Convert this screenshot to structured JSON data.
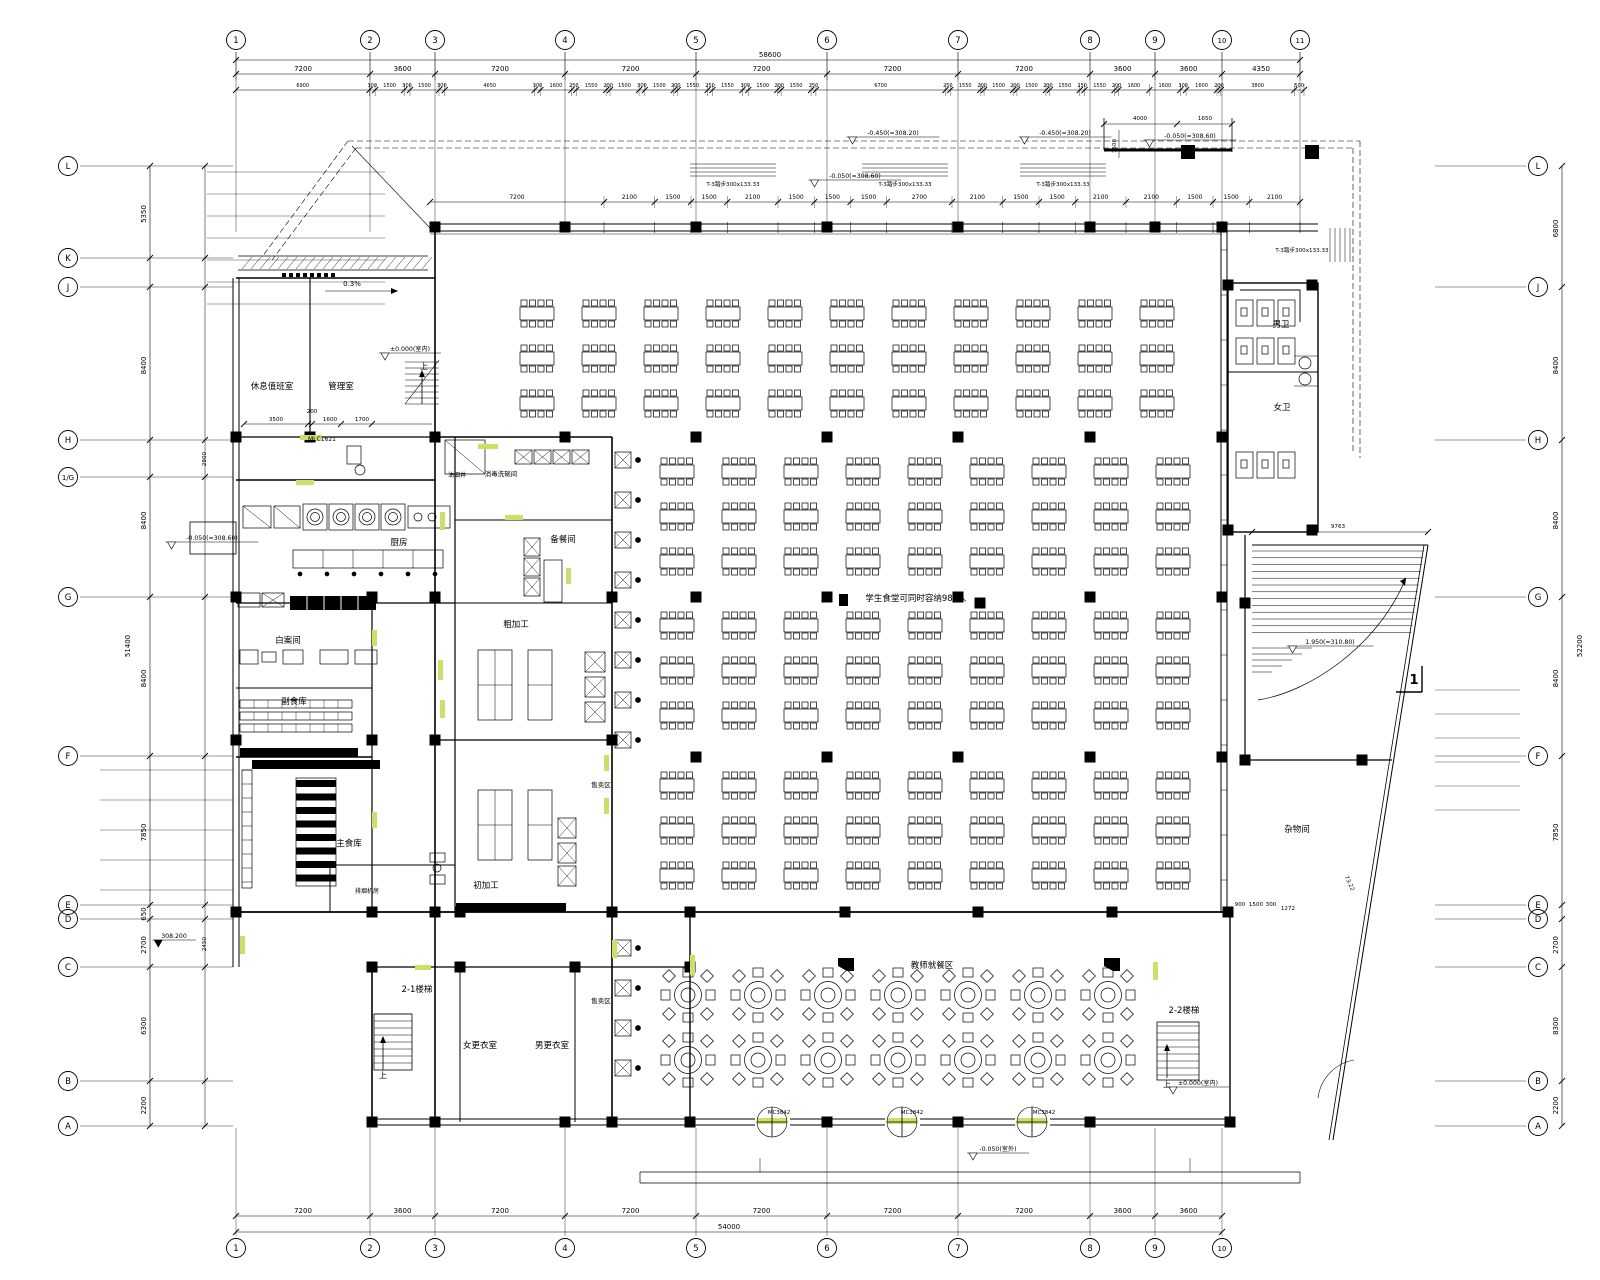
{
  "meta": {
    "drawing_type": "architectural-floor-plan",
    "language": "zh-CN"
  },
  "colors": {
    "line": "#000000",
    "background": "#ffffff",
    "door_highlight": "#c9e069",
    "column_fill": "#000000"
  },
  "axes": {
    "top": {
      "labels": [
        "1",
        "2",
        "3",
        "4",
        "5",
        "6",
        "7",
        "8",
        "9",
        "10",
        "11"
      ]
    },
    "bottom": {
      "labels": [
        "1",
        "2",
        "3",
        "4",
        "5",
        "6",
        "7",
        "8",
        "9",
        "10"
      ]
    },
    "left": {
      "labels": [
        "L",
        "K",
        "J",
        "H",
        "1/G",
        "G",
        "F",
        "E",
        "D",
        "C",
        "B",
        "A"
      ]
    },
    "right": {
      "labels": [
        "L",
        "J",
        "H",
        "G",
        "F",
        "E",
        "D",
        "C",
        "B",
        "A"
      ]
    }
  },
  "dimensions": {
    "top_total": "58600",
    "top_axis_dims": [
      "7200",
      "3600",
      "7200",
      "7200",
      "7200",
      "7200",
      "7200",
      "3600",
      "3600",
      "4350"
    ],
    "top_detail_dims": [
      "6900",
      "300",
      "1500",
      "300",
      "1500",
      "300",
      "4650",
      "300",
      "1600",
      "250",
      "1550",
      "200",
      "1500",
      "300",
      "1500",
      "200",
      "1550",
      "250",
      "1550",
      "300",
      "1500",
      "200",
      "1550",
      "250",
      "6700",
      "250",
      "1550",
      "200",
      "1500",
      "200",
      "1500",
      "200",
      "1550",
      "250",
      "1550",
      "200",
      "1600",
      "1600",
      "300",
      "1600",
      "200",
      "3800",
      "500"
    ],
    "window_dims": [
      "7200",
      "2100",
      "1500",
      "1500",
      "2100",
      "1500",
      "1500",
      "1500",
      "2700",
      "2100",
      "1500",
      "1500",
      "2100",
      "2100",
      "1500",
      "1500",
      "2100"
    ],
    "bottom_axis_dims": [
      "7200",
      "3600",
      "7200",
      "7200",
      "7200",
      "7200",
      "7200",
      "3600",
      "3600"
    ],
    "bottom_total": "54000",
    "left_axis_dims": [
      {
        "between": "L-K",
        "value": "5350"
      },
      {
        "between": "J-H",
        "value": "8400"
      },
      {
        "between": "H-G",
        "value": "8400"
      },
      {
        "between": "G-F",
        "value": "8400"
      },
      {
        "between": "F-E",
        "value": "7850"
      },
      {
        "between": "E-D",
        "value": "650"
      },
      {
        "between": "D-C",
        "value": "2700"
      },
      {
        "between": "C-B",
        "value": "6300"
      },
      {
        "between": "B-A",
        "value": "2200"
      }
    ],
    "left_total": "51400",
    "right_axis_dims": [
      {
        "between": "L-J",
        "value": "6800"
      },
      {
        "between": "J-H",
        "value": "8400"
      },
      {
        "between": "H-G",
        "value": "8400"
      },
      {
        "between": "G-F",
        "value": "8400"
      },
      {
        "between": "F-E",
        "value": "7850"
      },
      {
        "between": "D-C",
        "value": "2700"
      },
      {
        "between": "C-B",
        "value": "8300"
      },
      {
        "between": "B-A",
        "value": "2200"
      }
    ],
    "right_total": "52200",
    "misc": [
      {
        "t": "4000",
        "x": 1140,
        "y": 120
      },
      {
        "t": "1650",
        "x": 1205,
        "y": 120
      },
      {
        "t": "1500",
        "x": 1116,
        "y": 146,
        "rot": -90
      },
      {
        "t": "9763",
        "x": 1338,
        "y": 528
      },
      {
        "t": "3500",
        "x": 276,
        "y": 421
      },
      {
        "t": "200",
        "x": 312,
        "y": 413
      },
      {
        "t": "1600",
        "x": 330,
        "y": 421
      },
      {
        "t": "1700",
        "x": 362,
        "y": 421
      },
      {
        "t": "900",
        "x": 1240,
        "y": 906
      },
      {
        "t": "1500",
        "x": 1256,
        "y": 906
      },
      {
        "t": "300",
        "x": 1271,
        "y": 906
      },
      {
        "t": "1272",
        "x": 1288,
        "y": 910
      },
      {
        "t": "2800",
        "x": 206,
        "y": 459,
        "rot": -90
      },
      {
        "t": "2450",
        "x": 206,
        "y": 944,
        "rot": -90
      },
      {
        "t": "73.22",
        "x": 1348,
        "y": 884,
        "rot": 65
      }
    ]
  },
  "steps_note": "T-3踏步300x133.33",
  "steps_note_positions": [
    [
      733,
      186
    ],
    [
      905,
      186
    ],
    [
      1063,
      186
    ],
    [
      1302,
      252
    ]
  ],
  "elevations": [
    {
      "t": "-0.450(=308.20)",
      "x": 893,
      "y": 135
    },
    {
      "t": "-0.450(=308.20)",
      "x": 1065,
      "y": 135
    },
    {
      "t": "-0.050(=308.60)",
      "x": 1190,
      "y": 138
    },
    {
      "t": "-0.050(=308.60)",
      "x": 855,
      "y": 178
    },
    {
      "t": "±0.000(室内)",
      "x": 410,
      "y": 351
    },
    {
      "t": "-0.050(=308.60)",
      "x": 212,
      "y": 540
    },
    {
      "t": "308.200",
      "x": 174,
      "y": 938,
      "filled": true
    },
    {
      "t": "1.950(=310.80)",
      "x": 1330,
      "y": 644
    },
    {
      "t": "-0.050(室外)",
      "x": 998,
      "y": 1151
    },
    {
      "t": "±0.000(室内)",
      "x": 1198,
      "y": 1085
    }
  ],
  "rooms": [
    {
      "t": "休息值班室",
      "x": 272,
      "y": 389
    },
    {
      "t": "管理室",
      "x": 341,
      "y": 389
    },
    {
      "t": "油烟井",
      "x": 457,
      "y": 477,
      "s": 6
    },
    {
      "t": "消毒洗碗间",
      "x": 501,
      "y": 476,
      "s": 6.5
    },
    {
      "t": "备餐间",
      "x": 563,
      "y": 542
    },
    {
      "t": "厨房",
      "x": 399,
      "y": 545
    },
    {
      "t": "白案间",
      "x": 288,
      "y": 643
    },
    {
      "t": "副食库",
      "x": 294,
      "y": 704
    },
    {
      "t": "主食库",
      "x": 349,
      "y": 846
    },
    {
      "t": "排烟机房",
      "x": 367,
      "y": 893,
      "s": 6
    },
    {
      "t": "粗加工",
      "x": 516,
      "y": 627
    },
    {
      "t": "初加工",
      "x": 486,
      "y": 888
    },
    {
      "t": "售卖区",
      "x": 601,
      "y": 787,
      "s": 6.5
    },
    {
      "t": "售卖区",
      "x": 601,
      "y": 1003,
      "s": 6.5
    },
    {
      "t": "女更衣室",
      "x": 480,
      "y": 1048
    },
    {
      "t": "男更衣室",
      "x": 552,
      "y": 1048
    },
    {
      "t": "男卫",
      "x": 1281,
      "y": 327
    },
    {
      "t": "女卫",
      "x": 1282,
      "y": 410
    },
    {
      "t": "杂物间",
      "x": 1297,
      "y": 832
    },
    {
      "t": "2-1楼梯",
      "x": 417,
      "y": 992
    },
    {
      "t": "2-2楼梯",
      "x": 1184,
      "y": 1013
    },
    {
      "t": "教师就餐区",
      "x": 932,
      "y": 968
    },
    {
      "t": "学生食堂可同时容纳984人",
      "x": 916,
      "y": 601
    }
  ],
  "tags": [
    {
      "t": "MLC1621",
      "x": 322,
      "y": 441,
      "s": 6
    },
    {
      "t": "MC3842",
      "x": 779,
      "y": 1114,
      "s": 5.5
    },
    {
      "t": "MC3842",
      "x": 912,
      "y": 1114,
      "s": 5.5
    },
    {
      "t": "MC3842",
      "x": 1044,
      "y": 1114,
      "s": 5.5
    }
  ],
  "annotations": [
    {
      "t": "0.3%",
      "x": 352,
      "y": 286,
      "s": 7
    },
    {
      "t": "上",
      "x": 424,
      "y": 369,
      "s": 8
    },
    {
      "t": "上",
      "x": 383,
      "y": 1078,
      "s": 8
    },
    {
      "t": "上",
      "x": 1167,
      "y": 1087,
      "s": 8
    },
    {
      "t": "1",
      "x": 1414,
      "y": 684,
      "s": 13,
      "b": true
    }
  ],
  "dining_layout": {
    "capacity_note": "学生食堂可同时容纳984人",
    "student_area": {
      "table_type": "rect-8-seat",
      "rows_upper": 3,
      "cols_upper": 11,
      "rows_lower": 9,
      "cols_lower": 9
    },
    "teacher_area": {
      "table_type": "round-8-seat",
      "rows": 2,
      "cols": 7
    }
  }
}
